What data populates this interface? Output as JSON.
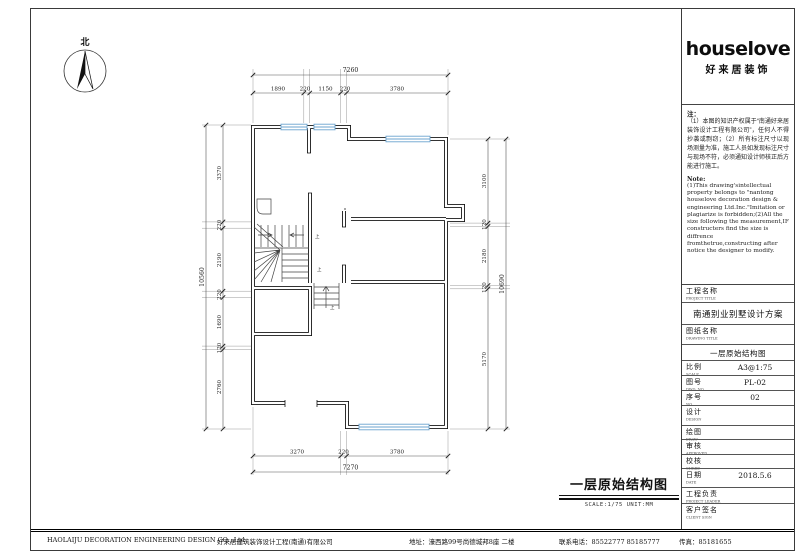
{
  "logo": {
    "brand": "houselove",
    "sub": "好来居装饰"
  },
  "north": {
    "label": "北"
  },
  "notes": {
    "cn_title": "注：",
    "cn_body": "（1）本图的知识产权属于“南通好来居装饰设计工程有限公司”，任何人不得抄袭或剽窃；（2）所有标注尺寸以现场测量为准，施工人员如发现标注尺寸与现场不符，必须通知设计师核正后方能进行施工。",
    "en_title": "Note:",
    "en_body": "(1)This drawing'sintellectual property belongs to \"nantong houselove decoration design & engineering Ltd.Inc.\"Imitation or plagiarize is forbidden;(2)All the size following the measurement,IF constructers find the size is diffrence fromthetrue,constructing after notice the designer to modify."
  },
  "titleblock": {
    "project_label": "工程名称",
    "project_label_en": "PROJECT TITLE",
    "project_value": "南通别业别墅设计方案",
    "drawing_label": "图纸名称",
    "drawing_label_en": "DRAWING TITLE",
    "drawing_value": "一层原始结构图",
    "scale_label": "比例",
    "scale_label_en": "SCALE",
    "scale_value": "A3@1:75",
    "dwg_label": "图号",
    "dwg_label_en": "DWG. NO",
    "dwg_value": "PL-02",
    "no_label": "序号",
    "no_label_en": "NO.",
    "no_value": "02",
    "design_label": "设计",
    "design_label_en": "DESIGN",
    "draw_label": "绘图",
    "draw_label_en": "DRAW",
    "approve_label": "审核",
    "approve_label_en": "APPROVED",
    "check_label": "校核",
    "check_label_en": "CHKED",
    "date_label": "日期",
    "date_label_en": "DATE",
    "date_value": "2018.5.6",
    "leader_label": "工程负责",
    "leader_label_en": "PROJECT LEADER",
    "client_label": "客户签名",
    "client_label_en": "CLIENT SIGN"
  },
  "plan_title": {
    "text": "一层原始结构图",
    "meta": "SCALE:1/75  UNIT:MM"
  },
  "dims": {
    "top": {
      "overall": "7260",
      "segments": [
        "1890",
        "220",
        "1150",
        "220",
        "3780"
      ]
    },
    "bottom": {
      "overall": "7270",
      "segments": [
        "3270",
        "220",
        "3780"
      ]
    },
    "left": {
      "overall": "10560",
      "segments": [
        "3370",
        "220",
        "2190",
        "220",
        "1690",
        "120",
        "2760"
      ]
    },
    "right": {
      "overall": "10690",
      "segments": [
        "3100",
        "120",
        "2180",
        "120",
        "5170"
      ]
    }
  },
  "stairs": {
    "up1": "上",
    "up2": "上",
    "up3": "上"
  },
  "footer": {
    "company_en": "HAOLAIJU  DECORATION ENGINEERING DESIGN CO., Ltd",
    "company_cn": "好来居建筑装饰设计工程(南通)有限公司",
    "address": "地址：濠西路99号尚德城邦8座 二楼",
    "phone": "联系电话：85522777 85185777",
    "fax": "传真：85181655"
  }
}
